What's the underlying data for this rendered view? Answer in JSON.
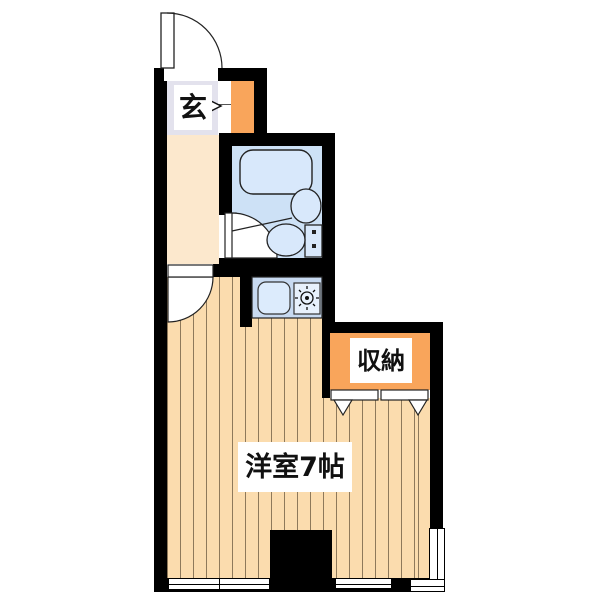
{
  "title": "apartment-floor-plan",
  "labels": {
    "entrance": "玄",
    "storage": "収納",
    "main_room": "洋室7帖"
  },
  "colors": {
    "wall": "#000000",
    "wood_floor": "#fbdcae",
    "hallway_floor": "#fce8cd",
    "entrance_floor": "#e3e2ed",
    "cabinet_orange": "#f9a55b",
    "bathroom_floor": "#cde1f6",
    "fixture_blue": "#d8e8fb",
    "kitchen_counter_blue": "#c8daf1"
  },
  "icons": {
    "entry_door": "door-swing-arc",
    "room_door": "door-swing-arc",
    "bathroom_door": "door-swing-arc",
    "bathtub": "rounded-rect-tub",
    "washbasin": "ellipse-basin",
    "toilet": "bowl-and-tank",
    "kitchen_sink": "rounded-square-sink",
    "stove": "burner-star",
    "closet_door": "folding-panels-with-chevrons",
    "entry_direction": "right-chevron"
  }
}
